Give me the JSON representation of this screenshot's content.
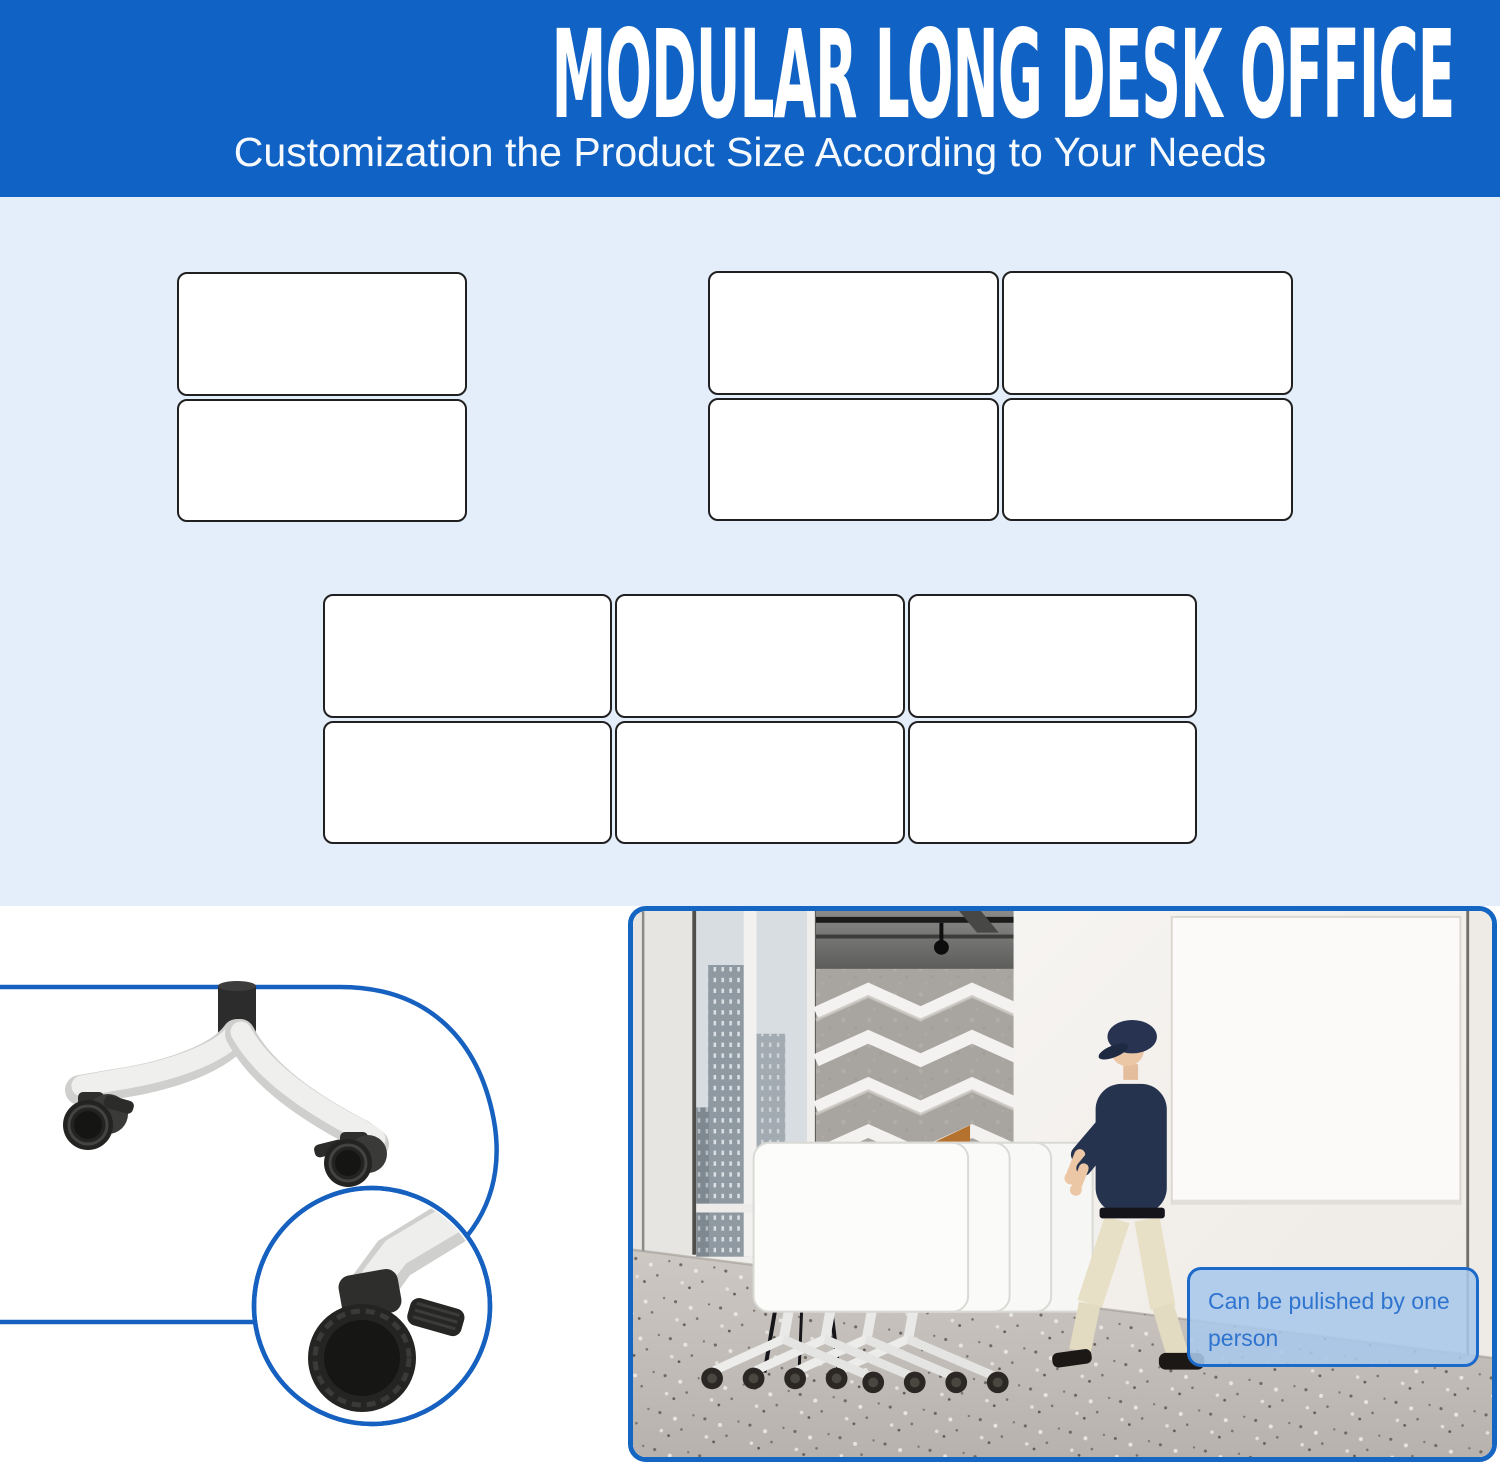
{
  "header": {
    "title": "MODULAR LONG DESK OFFICE",
    "subtitle": "Customization the Product Size According to Your Needs",
    "bg_color": "#1063c5",
    "text_color": "#ffffff"
  },
  "layout_section": {
    "bg_color": "#e4eefb",
    "desk_fill": "#ffffff",
    "desk_border": "#202020",
    "groups": [
      {
        "id": "grid-a",
        "rows": 2,
        "cols": 1
      },
      {
        "id": "grid-b",
        "rows": 2,
        "cols": 2
      },
      {
        "id": "grid-c",
        "rows": 2,
        "cols": 3
      }
    ]
  },
  "detail_section": {
    "accent_color": "#1660bf",
    "leg_color": "#efefed",
    "caster_color": "#232321"
  },
  "photo_section": {
    "border_color": "#1565c2",
    "caption": "Can be pulished by one person",
    "caption_text_color": "#2f74cf",
    "caption_bg_color": "#a8c8eb",
    "caption_border_color": "#1b6ac9"
  }
}
